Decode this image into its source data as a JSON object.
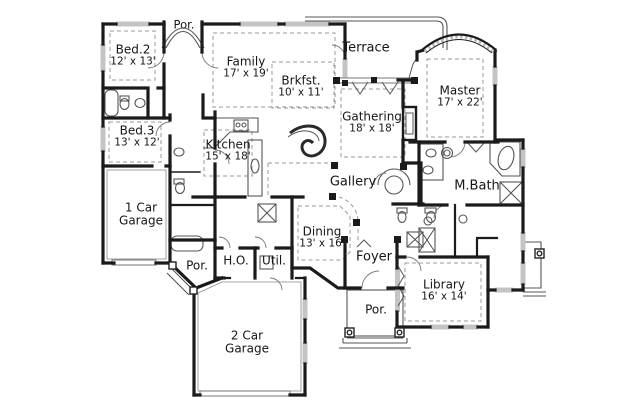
{
  "plan": {
    "type": "floor-plan",
    "rooms": [
      {
        "id": "por-top",
        "line1": "Por."
      },
      {
        "id": "bed2",
        "line1": "Bed.2",
        "line2": "12' x 13'"
      },
      {
        "id": "family",
        "line1": "Family",
        "line2": "17' x 19'"
      },
      {
        "id": "brkfst",
        "line1": "Brkfst.",
        "line2": "10' x 11'"
      },
      {
        "id": "terrace",
        "line1": "Terrace"
      },
      {
        "id": "master",
        "line1": "Master",
        "line2": "17' x 22'"
      },
      {
        "id": "gathering",
        "line1": "Gathering",
        "line2": "18' x 18'"
      },
      {
        "id": "bed3",
        "line1": "Bed.3",
        "line2": "13' x 12'"
      },
      {
        "id": "kitchen",
        "line1": "Kitchen",
        "line2": "15' x 18'"
      },
      {
        "id": "gallery",
        "line1": "Gallery"
      },
      {
        "id": "mbath",
        "line1": "M.Bath"
      },
      {
        "id": "garage1",
        "line1": "1 Car",
        "line2": "Garage"
      },
      {
        "id": "dining",
        "line1": "Dining",
        "line2": "13' x 16'"
      },
      {
        "id": "por-left",
        "line1": "Por."
      },
      {
        "id": "ho",
        "line1": "H.O."
      },
      {
        "id": "util",
        "line1": "Util."
      },
      {
        "id": "foyer",
        "line1": "Foyer"
      },
      {
        "id": "library",
        "line1": "Library",
        "line2": "16' x 14'"
      },
      {
        "id": "por-bottom",
        "line1": "Por."
      },
      {
        "id": "garage2",
        "line1": "2 Car",
        "line2": "Garage"
      }
    ],
    "colors": {
      "wall": "#1b1b1b",
      "thin": "#555555",
      "dashed": "#9a9a9a",
      "window": "#c4c4c4",
      "background": "#ffffff"
    }
  }
}
